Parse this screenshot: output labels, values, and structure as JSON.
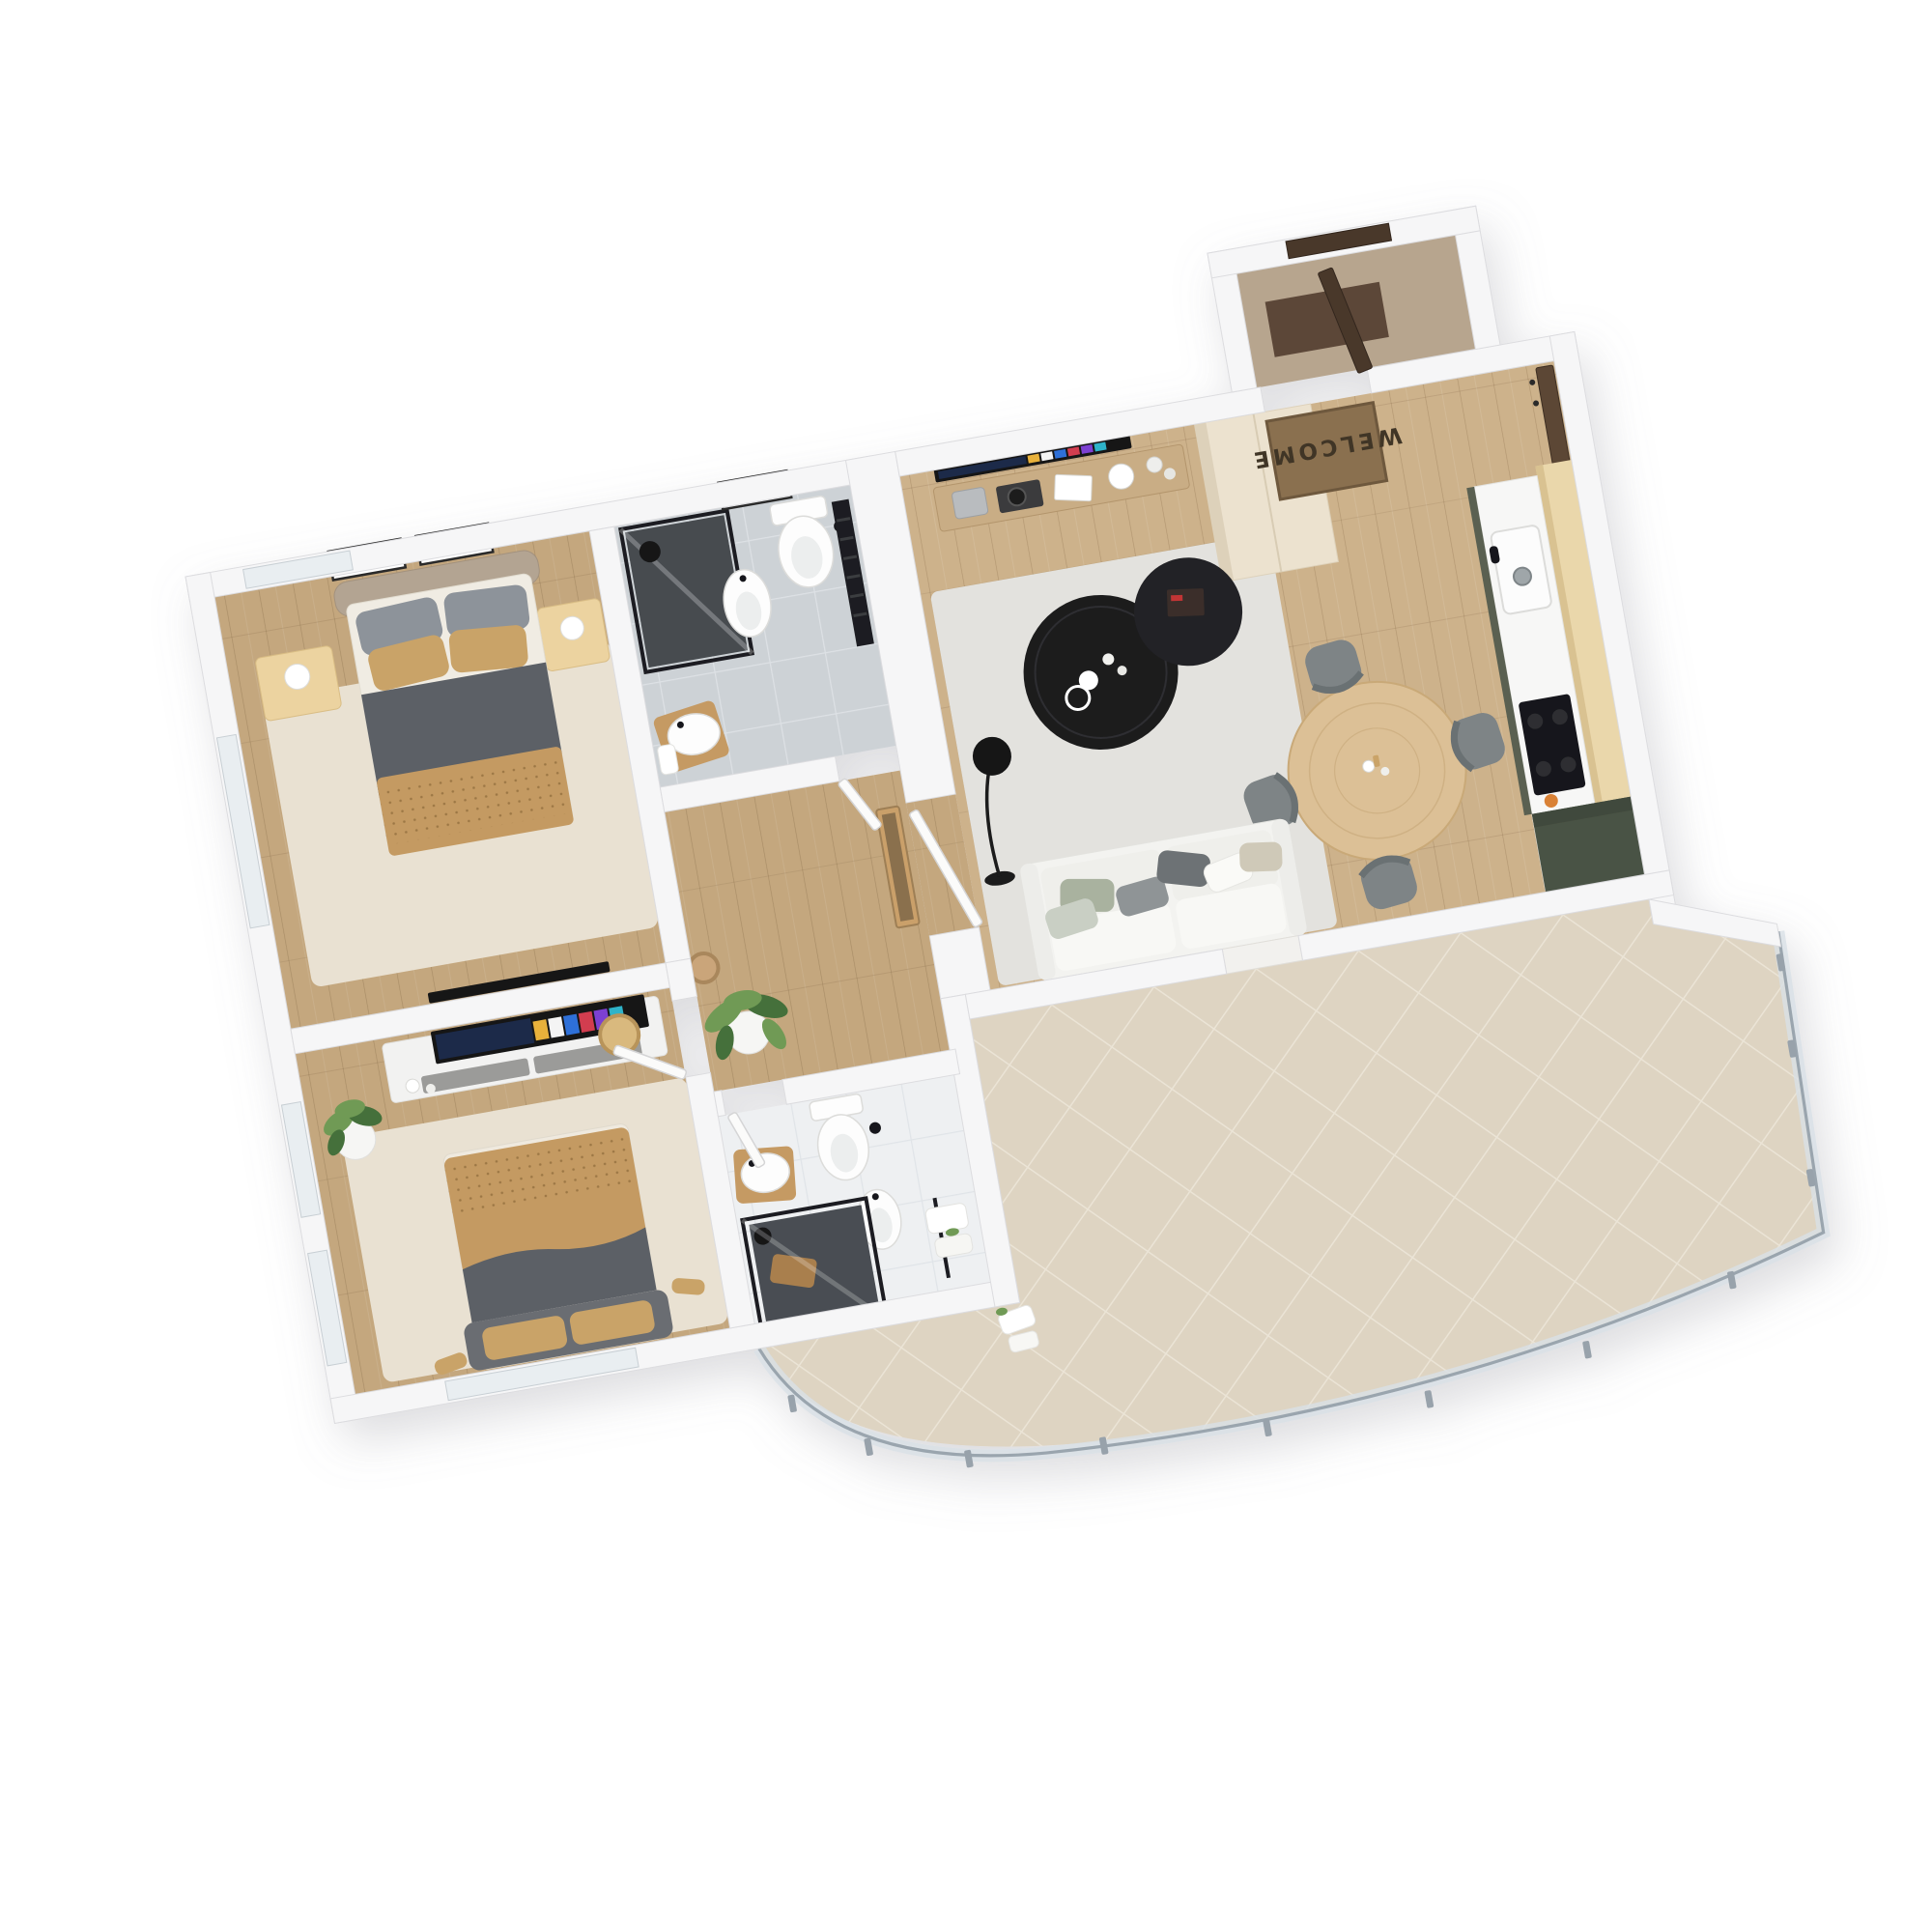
{
  "meta": {
    "title": "3D isometric floor plan render — two-bedroom apartment with large curved terrace",
    "style": "photoreal top-down dollhouse view on white background"
  },
  "entrance": {
    "doormat_text": "WELCOME",
    "items": [
      "entry-door-open",
      "welcome-doormat",
      "coat-mirror-panel",
      "tall-cream-wardrobe"
    ]
  },
  "rooms": {
    "bedroom_primary": {
      "name": "bedroom 1 (top-left)",
      "furniture": [
        "double-bed",
        "taupe-headboard",
        "gray-pillows",
        "tan-pillows",
        "dark-gray-duvet",
        "tan-dotted-blanket",
        "nightstand-left",
        "nightstand-right",
        "white-cone-lamps",
        "two-wall-artworks",
        "cream-shag-rug",
        "wall-tv",
        "window-left"
      ]
    },
    "bedroom_second": {
      "name": "bedroom 2 (bottom-left)",
      "furniture": [
        "double-bed",
        "tan-dotted-blanket",
        "dark-gray-duvet",
        "gray-headboard",
        "tan-pillows",
        "media-console",
        "smart-tv-app-screen",
        "woven-plate-decor",
        "rubber-plant-white-pot",
        "cream-shag-rug",
        "slippers",
        "windows-left-and-bottom"
      ]
    },
    "bathroom_top": {
      "name": "bathroom 1 (gray tile)",
      "furniture": [
        "black-frame-shower",
        "bidet",
        "wall-hung-toilet",
        "round-basin-on-stool",
        "black-towel-radiator",
        "wall-art",
        "white-door"
      ]
    },
    "bathroom_bottom": {
      "name": "bathroom 2 (white tile)",
      "furniture": [
        "black-frame-shower-with-stool",
        "wall-hung-toilet",
        "bidet",
        "round-basin-on-stool",
        "towel-rack-white-towels",
        "white-door"
      ]
    },
    "hallway": {
      "name": "hall (center)",
      "furniture": [
        "dieffenbachia-plant",
        "leaning-gold-mirror",
        "woven-basket"
      ]
    },
    "living_room": {
      "name": "open living / dining / kitchen",
      "furniture": [
        "white-three-seat-sofa",
        "mixed-throw-pillows",
        "light-gray-rug",
        "two-round-black-coffee-tables",
        "magazine-and-cups",
        "black-arc-floor-lamp",
        "wall-mounted-smart-tv",
        "floating-media-shelf",
        "speaker",
        "turntable",
        "round-wood-dining-table",
        "four-gray-chairs",
        "sphere-candle-lights-on-half-wall",
        "plant-on-half-wall",
        "terrace-threshold"
      ]
    },
    "kitchen": {
      "name": "kitchen run (right wall)",
      "furniture": [
        "light-wood-tall-panel",
        "white-countertop",
        "inset-sink",
        "black-cooktop",
        "olive-green-base-cabinets",
        "olive-green-tall-unit",
        "orange-fruit"
      ]
    },
    "terrace": {
      "name": "curved terrace",
      "furniture": [
        "beige-diagonal-tiles",
        "glass-railing",
        "railing-posts",
        "white-towels-on-wall"
      ],
      "railing_posts_count": 11
    }
  },
  "counts": {
    "dining_chairs": 4,
    "sphere_lights": 5,
    "wall_artworks_bedroom1": 2
  },
  "colors": {
    "wall_face": "#f6f6f7",
    "wall_edge": "#dcdcdf",
    "floor_wood": "#cdb28b",
    "floor_wood_dark": "#c4a77e",
    "terrace_tile": "#ded4c2",
    "terrace_grout": "#ebe4d6",
    "rug_cream": "#e9e1d2",
    "rug_gray": "#e3e2de",
    "tile_bath1": "#cdd2d6",
    "tile_bath2": "#eef0f2",
    "fixture_white": "#fdfdfd",
    "duvet_gray": "#5c6066",
    "blanket_tan": "#c49a62",
    "pillow_gray": "#8d939a",
    "pillow_tan": "#c9a368",
    "headboard_taupe": "#b3a492",
    "nightstand_wood": "#ecd3a0",
    "console_white": "#f2f2f1",
    "drawer_gray": "#9b9b99",
    "tv_black": "#161618",
    "plant_green": "#6f9a55",
    "plant_dark": "#44703a",
    "pot_white": "#f6f6f4",
    "kitchen_wood": "#ead7ab",
    "kitchen_green": "#5a6151",
    "kitchen_green_dark": "#4a5244",
    "counter_white": "#f7f7f6",
    "cooktop_black": "#17181a",
    "wardrobe_cream": "#ece2cf",
    "door_brown": "#4a382c",
    "mat_brown": "#8a7050",
    "mat_text": "#3f3526",
    "table_wood": "#dcc096",
    "chair_gray": "#7e8486",
    "sofa_white": "#f3f3f0",
    "coffee_black": "#1d1d1f",
    "railing_glass": "#d8e0e6",
    "railing_post": "#98a2ab",
    "shadow": "#8e8e96"
  }
}
